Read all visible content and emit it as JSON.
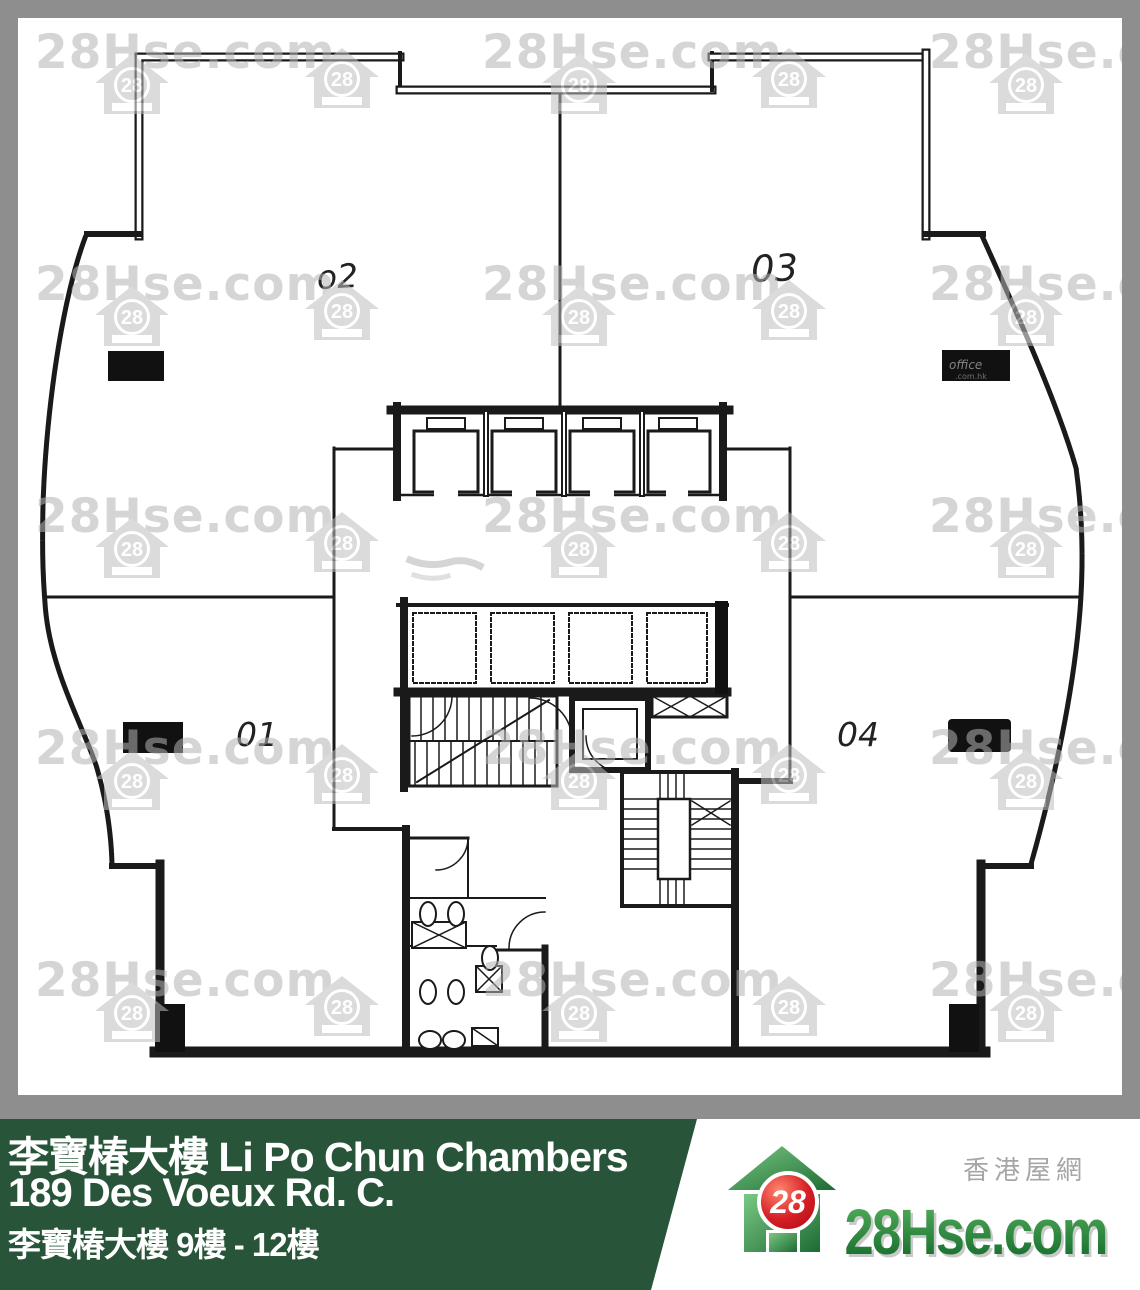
{
  "plan": {
    "units": [
      {
        "id": "02",
        "label": "o2"
      },
      {
        "id": "03",
        "label": "03"
      },
      {
        "id": "01",
        "label": "01"
      },
      {
        "id": "04",
        "label": "04"
      }
    ],
    "stamp_line1": "office",
    "stamp_line2": ".com.hk"
  },
  "watermark": {
    "text": "28Hse.com",
    "badge": "28"
  },
  "footer": {
    "building_title": "李寶椿大樓 Li Po Chun Chambers",
    "address": "189 Des Voeux Rd. C.",
    "floor_range": "李寶椿大樓 9樓 - 12樓"
  },
  "logo": {
    "badge": "28",
    "brand": "28Hse.com",
    "tagline": "香港屋網"
  },
  "colors": {
    "frame": "#8e8e8e",
    "panel_green": "#285539",
    "logo_green_light": "#56b35f",
    "logo_green_dark": "#0f6426",
    "logo_red": "#c8141d",
    "watermark_gray": "#b9b9b9",
    "ink": "#1a1a1a"
  }
}
